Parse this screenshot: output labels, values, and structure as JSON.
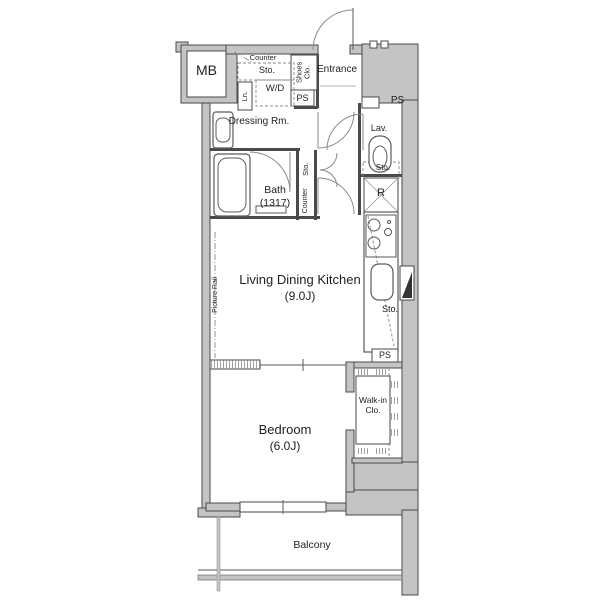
{
  "plan_title": "1K apartment floor plan",
  "labels": {
    "mb": "MB",
    "counter": "Counter",
    "sto": "Sto.",
    "wd": "W/D",
    "ln": "Ln.",
    "shoes_clo": "Shoes Clo.",
    "ps": "PS",
    "entrance": "Entrance",
    "dressing_rm": "Dressing Rm.",
    "lav": "Lav.",
    "bath": "Bath",
    "bath_dim": "(1317)",
    "refrigerator": "R",
    "ldk": "Living Dining Kitchen",
    "ldk_size": "(9.0J)",
    "picture_rail": "Picture Rail",
    "bedroom": "Bedroom",
    "bedroom_size": "(6.0J)",
    "walk_in_clo": "Walk-in Clo.",
    "balcony": "Balcony"
  },
  "colors": {
    "background": "#ffffff",
    "wall_fill": "#c4c4c4",
    "outline": "#4a4a4a",
    "line": "#5a5a5a",
    "light": "#8a8a8a",
    "text": "#1f1f1f"
  }
}
